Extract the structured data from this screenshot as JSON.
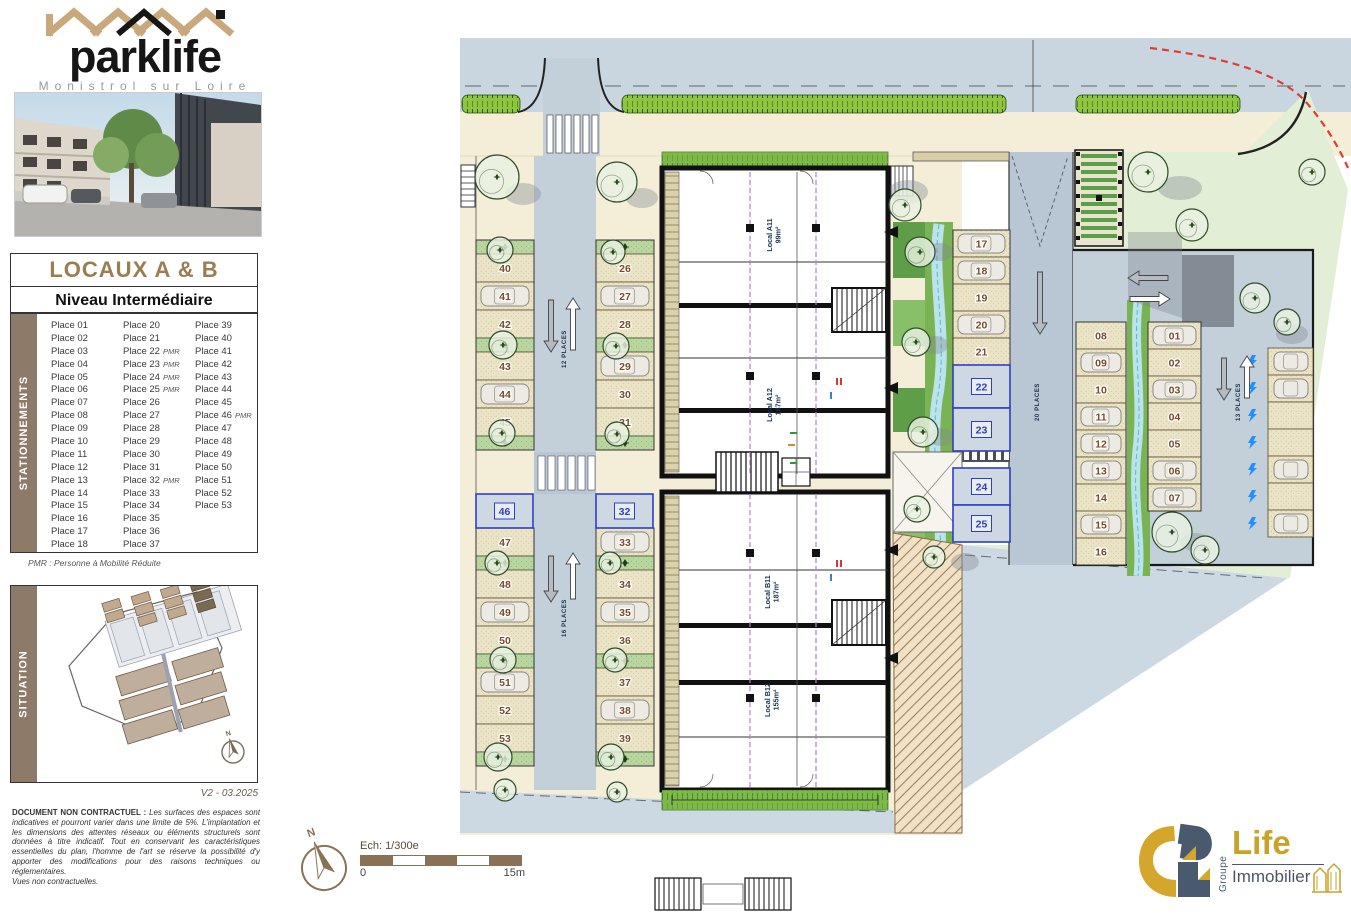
{
  "brand": {
    "name": "parklife",
    "subtitle": "Monistrol sur Loire"
  },
  "title_block": {
    "title": "LOCAUX A & B",
    "subtitle": "Niveau Intermédiaire"
  },
  "stationnements": {
    "sidebar_label": "STATIONNEMENTS",
    "pmr_suffix": "PMR",
    "columns": [
      [
        "Place 01",
        "Place 02",
        "Place 03",
        "Place 04",
        "Place 05",
        "Place 06",
        "Place 07",
        "Place 08",
        "Place 09",
        "Place 10",
        "Place 11",
        "Place 12",
        "Place 13",
        "Place 14",
        "Place 15",
        "Place 16",
        "Place 17",
        "Place 18"
      ],
      [
        "Place 20",
        "Place 21",
        "Place 22",
        "Place 23",
        "Place 24",
        "Place 25",
        "Place 26",
        "Place 27",
        "Place 28",
        "Place 29",
        "Place 30",
        "Place 31",
        "Place 32",
        "Place 33",
        "Place 34",
        "Place 35",
        "Place 36",
        "Place 37"
      ],
      [
        "Place 39",
        "Place 40",
        "Place 41",
        "Place 42",
        "Place 43",
        "Place 44",
        "Place 45",
        "Place 46",
        "Place 47",
        "Place 48",
        "Place 49",
        "Place 50",
        "Place 51",
        "Place 52",
        "Place 53"
      ]
    ],
    "pmr_flags": [
      [],
      [
        2,
        3,
        4,
        5,
        12
      ],
      [
        7
      ]
    ],
    "pmr_note": "PMR : Personne à Mobilité Réduite"
  },
  "situation": {
    "sidebar_label": "SITUATION",
    "north_label": "N",
    "version": "V2 - 03.2025"
  },
  "disclaimer": {
    "heading": "DOCUMENT NON CONTRACTUEL :",
    "body": "Les surfaces des espaces sont indicatives et pourront varier dans une limite de 5%. L'implantation et les dimensions des attentes réseaux ou éléments structurels sont données à titre indicatif. Tout en conservant les caractéristiques essentielles du plan, l'homme de l'art se réserve la possibilité d'y apporter des modifications pour des raisons techniques ou réglementaires.",
    "footer": "Vues non contractuelles."
  },
  "footer_bar": {
    "scale_label": "Ech: 1/300e",
    "scale_start": "0",
    "scale_end": "15m",
    "north_label": "N"
  },
  "life_logo": {
    "group": "Groupe",
    "name": "Life",
    "type": "Immobilier"
  },
  "plan": {
    "locals": [
      {
        "name": "Local A11",
        "area": "99m²"
      },
      {
        "name": "Local A12",
        "area": "187m²"
      },
      {
        "name": "Local B11",
        "area": "187m²"
      },
      {
        "name": "Local B12",
        "area": "155m²"
      }
    ],
    "lanes": [
      {
        "label": "12 PLACES",
        "x": 563,
        "y": 349
      },
      {
        "label": "16 PLACES",
        "x": 563,
        "y": 618
      },
      {
        "label": "20 PLACES",
        "x": 1036,
        "y": 402
      },
      {
        "label": "13 PLACES",
        "x": 1237,
        "y": 402
      }
    ],
    "groups": [
      {
        "x": 476,
        "w": 58,
        "y": 240,
        "h": 28,
        "rows": [
          "g",
          "40",
          "41",
          "42",
          "g",
          "43",
          "44",
          "45",
          "g"
        ],
        "cars": [
          "41",
          "44"
        ]
      },
      {
        "x": 596,
        "w": 58,
        "y": 240,
        "h": 28,
        "rows": [
          "g",
          "26",
          "27",
          "28",
          "g",
          "29",
          "30",
          "31",
          "g"
        ],
        "cars": [
          "27",
          "29"
        ]
      },
      {
        "x": 476,
        "w": 58,
        "y": 528,
        "h": 28,
        "rows": [
          "47",
          "g",
          "48",
          "49",
          "50",
          "g",
          "51",
          "52",
          "53",
          "g"
        ],
        "cars": [
          "49",
          "51"
        ]
      },
      {
        "x": 596,
        "w": 58,
        "y": 528,
        "h": 28,
        "rows": [
          "33",
          "g",
          "34",
          "35",
          "36",
          "g",
          "37",
          "38",
          "39",
          "g"
        ],
        "cars": [
          "33",
          "35",
          "38"
        ]
      },
      {
        "x": 953,
        "w": 57,
        "y": 230,
        "h": 27,
        "rows": [
          "17",
          "18",
          "19",
          "20",
          "21"
        ],
        "cars": [
          "17",
          "18",
          "20"
        ]
      },
      {
        "x": 1076,
        "w": 50,
        "y": 322,
        "h": 27,
        "rows": [
          "08",
          "09",
          "10",
          "11",
          "12",
          "13",
          "14",
          "15",
          "16"
        ],
        "cars": [
          "09",
          "11",
          "12",
          "13",
          "15"
        ]
      },
      {
        "x": 1148,
        "w": 53,
        "y": 322,
        "h": 27,
        "rows": [
          "01",
          "02",
          "03",
          "04",
          "05",
          "06",
          "07"
        ],
        "cars": [
          "01",
          "03",
          "06",
          "07"
        ]
      }
    ],
    "pmr_boxes": [
      {
        "x": 476,
        "y": 494,
        "w": 57,
        "h": 34,
        "n": "46"
      },
      {
        "x": 596,
        "y": 494,
        "w": 57,
        "h": 34,
        "n": "32"
      },
      {
        "x": 953,
        "y": 365,
        "w": 57,
        "h": 43,
        "n": "22"
      },
      {
        "x": 953,
        "y": 408,
        "w": 57,
        "h": 43,
        "n": "23"
      },
      {
        "x": 953,
        "y": 468,
        "w": 57,
        "h": 37,
        "n": "24"
      },
      {
        "x": 953,
        "y": 505,
        "w": 57,
        "h": 37,
        "n": "25"
      }
    ],
    "ev_stall_count": 7,
    "colors": {
      "road": "#c9d6e0",
      "lane": "#c3d0da",
      "sidewalk": "#f4eed8",
      "hedge": "#8ec43e",
      "lawn": "#e3eed6",
      "stall_beige": "#eae3c6",
      "stall_green": "#b9d6a0",
      "number_brown": "#7b4a28",
      "pmr_blue": "#2f3fbe",
      "stream": "#bfe6f2",
      "hatch_tan": "#f0e2c8",
      "red_dash": "#e23b30",
      "brand_brown": "#8d7a69",
      "logo_gold": "#c9a227",
      "logo_slate": "#4a5a6e"
    }
  }
}
